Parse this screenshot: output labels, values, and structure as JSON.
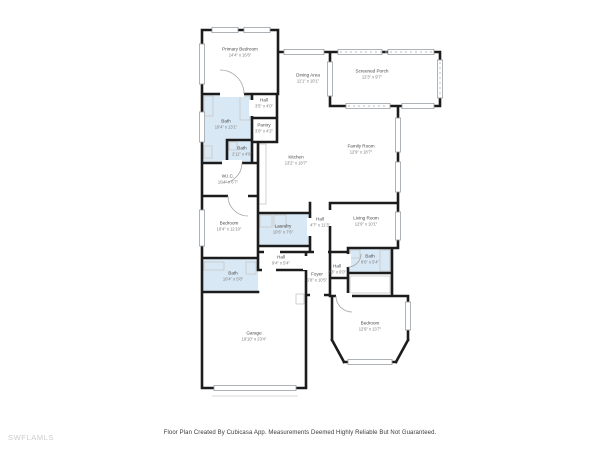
{
  "watermark": "SWFLAMLS",
  "footer": "Floor Plan Created By Cubicasa App. Measurements Deemed Highly Reliable But Not Guaranteed.",
  "colors": {
    "wall": "#1c1c1c",
    "wet_room_fill": "#d9e8f5",
    "window_line": "#9aa0a6",
    "room_name_text": "#4a4a4a",
    "room_dims_text": "#7b7b7b",
    "watermark_text": "#cccccc"
  },
  "rooms": [
    {
      "id": "primary-bedroom",
      "name": "Primary Bedroom",
      "dims": "14'4\" x 16'6\""
    },
    {
      "id": "dining-area",
      "name": "Dining Area",
      "dims": "11'1\" x 10'1\""
    },
    {
      "id": "screened-porch",
      "name": "Screened Porch",
      "dims": "12'3\" x 9'7\""
    },
    {
      "id": "hall-upper",
      "name": "Hall",
      "dims": "3'5\" x 4'0\""
    },
    {
      "id": "bath-primary",
      "name": "Bath",
      "dims": "10'4\" x 13'1\""
    },
    {
      "id": "pantry",
      "name": "Pantry",
      "dims": "3'0\" x 4'2\""
    },
    {
      "id": "bath-small",
      "name": "Bath",
      "dims": "2'11\" x 4'8\""
    },
    {
      "id": "kitchen",
      "name": "Kitchen",
      "dims": "13'2\" x 18'7\""
    },
    {
      "id": "family-room",
      "name": "Family Room",
      "dims": "12'9\" x 18'7\""
    },
    {
      "id": "wic",
      "name": "W.I.C.",
      "dims": "10'4\" x 6'7\""
    },
    {
      "id": "bedroom-left",
      "name": "Bedroom",
      "dims": "10'4\" x 12'10\""
    },
    {
      "id": "laundry",
      "name": "Laundry",
      "dims": "10'6\" x 7'6\""
    },
    {
      "id": "hall-center",
      "name": "Hall",
      "dims": "4'7\" x 11'3\""
    },
    {
      "id": "living-room",
      "name": "Living Room",
      "dims": "12'9\" x 10'1\""
    },
    {
      "id": "bath-lower-left",
      "name": "Bath",
      "dims": "10'4\" x 5'8\""
    },
    {
      "id": "hall-lower",
      "name": "Hall",
      "dims": "9'4\" x 5'4\""
    },
    {
      "id": "foyer",
      "name": "Foyer",
      "dims": "5'8\" x 10'5\""
    },
    {
      "id": "hall-foyer",
      "name": "Hall",
      "dims": "3'3\" x 6'0\""
    },
    {
      "id": "bath-right",
      "name": "Bath",
      "dims": "8'6\" x 5'4\""
    },
    {
      "id": "garage",
      "name": "Garage",
      "dims": "19'10\" x 23'4\""
    },
    {
      "id": "bedroom-right",
      "name": "Bedroom",
      "dims": "12'9\" x 13'7\""
    }
  ]
}
